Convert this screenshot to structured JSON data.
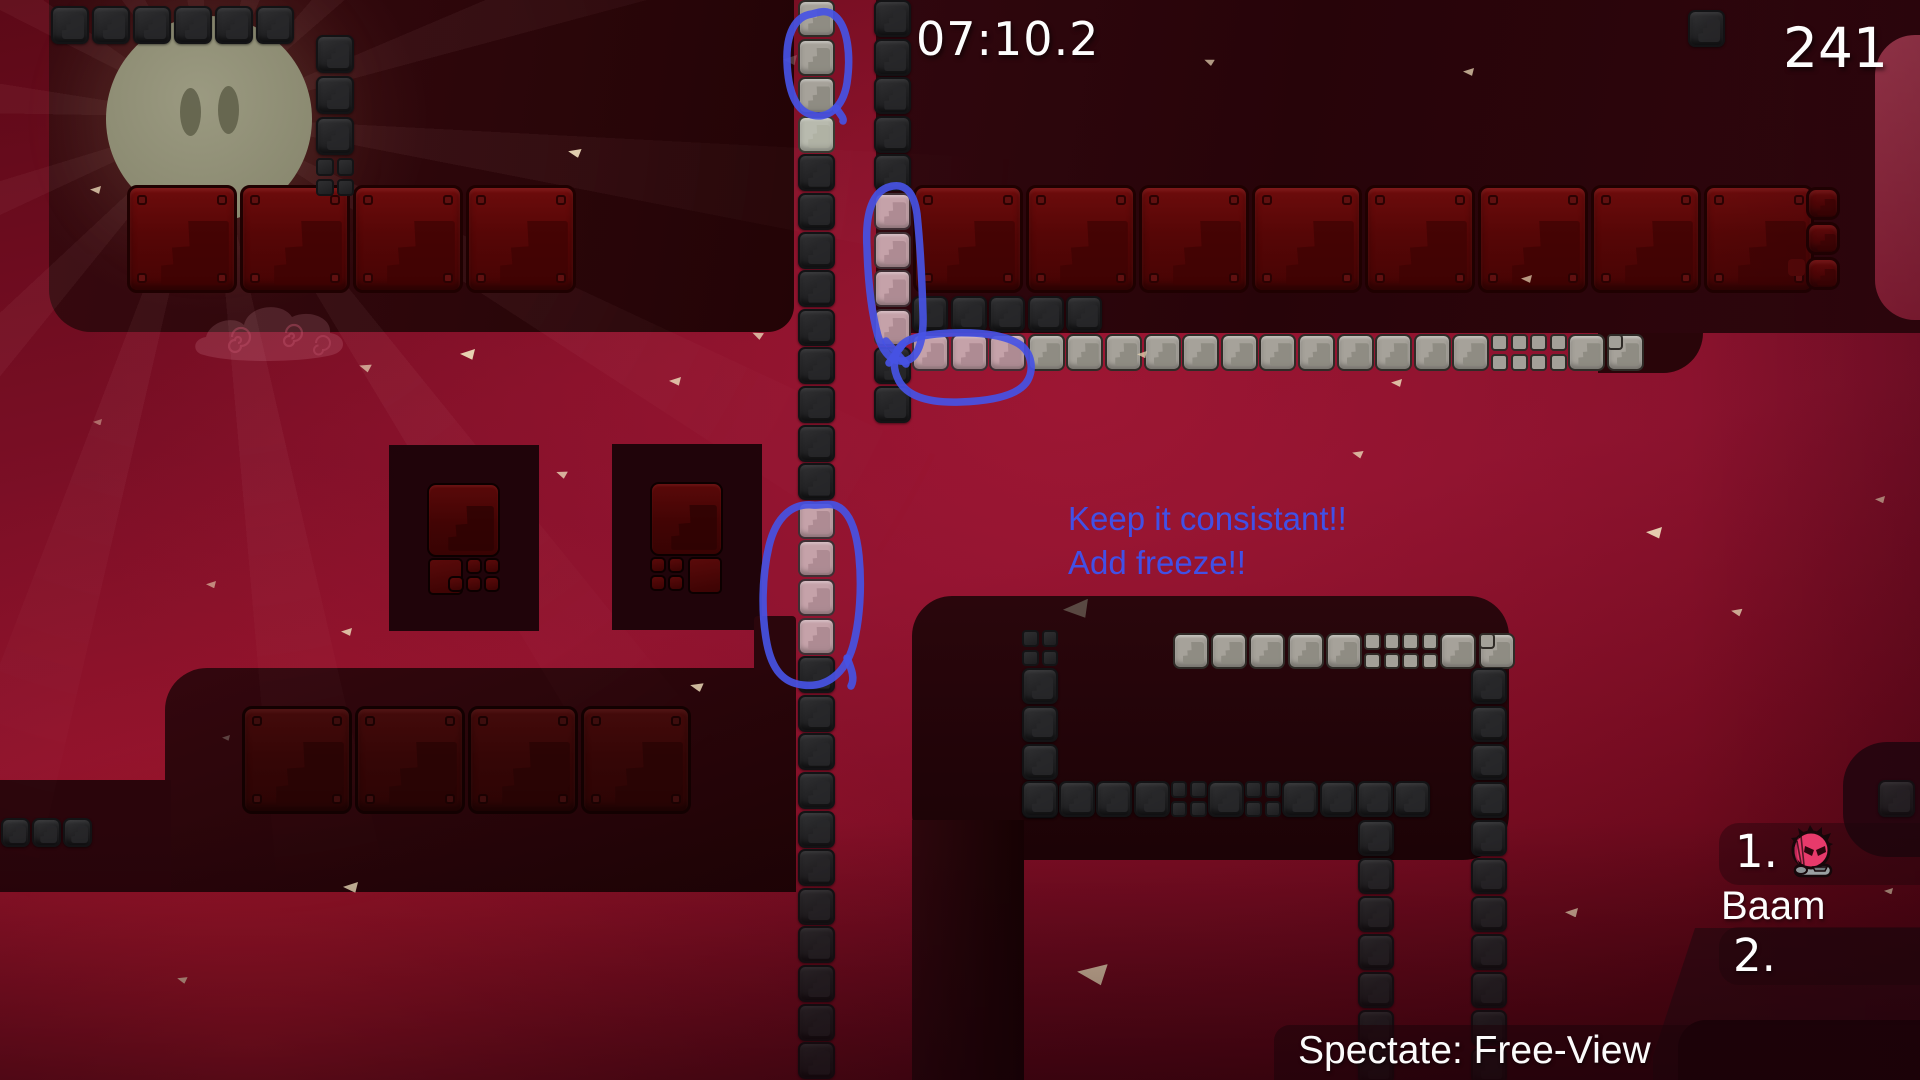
{
  "hud": {
    "timer": "07:10.2",
    "score": "241",
    "spectate_label": "Spectate: Free-View"
  },
  "leaderboard": {
    "entries": [
      {
        "rank": "1.",
        "name": "Baam",
        "icon": "pink-creature-icon"
      },
      {
        "rank": "2.",
        "name": ""
      }
    ]
  },
  "annotations": {
    "ink_color": "#4652e4",
    "text_color": "#4150e6",
    "notes": [
      "Keep it consistant!!",
      "Add freeze!!"
    ]
  },
  "palette": {
    "hud_text": "#fdfdfd",
    "brick_red": "#5c0808",
    "tile_dark": "#242426",
    "tile_light": "#a6a29a",
    "tile_pink": "#c5a2a9",
    "slab_dark": "#2a060c",
    "moon": "#93927b",
    "pillar_red": "#9e2e44"
  },
  "level": {
    "moon": {
      "eyes": 2
    },
    "slabs": [
      {
        "name": "slab-top-left",
        "x": 49,
        "y": 0,
        "w": 745,
        "h": 332,
        "r": "0 0 26px 42px",
        "bg": "radial-gradient(300px 280px at 170px 120px, rgba(190,120,95,.16), transparent 70%), linear-gradient(100deg,#37090f,#230406)"
      },
      {
        "name": "slab-top-right",
        "x": 876,
        "y": 0,
        "w": 1044,
        "h": 333,
        "r": "0",
        "bg": "linear-gradient(100deg,#30070e,#270409 40%,#2f060d)"
      },
      {
        "name": "slab-mid-left",
        "x": 165,
        "y": 668,
        "w": 631,
        "h": 224,
        "r": "42px 0 0 0",
        "bg": "linear-gradient(160deg,#33070e,#1e0305)"
      },
      {
        "name": "slab-mid-left-ext",
        "x": 0,
        "y": 780,
        "w": 171,
        "h": 112,
        "r": "0",
        "bg": "#2a050b"
      },
      {
        "name": "slab-bottom-mid",
        "x": 912,
        "y": 596,
        "w": 597,
        "h": 264,
        "r": "40px 40px 46px 46px",
        "bg": "linear-gradient(180deg,#2a060c,#1c0306)"
      },
      {
        "name": "slab-bottom-mid-arm",
        "x": 912,
        "y": 820,
        "w": 112,
        "h": 260,
        "r": "0",
        "bg": "linear-gradient(90deg,#2e070d,#160203)"
      },
      {
        "name": "slab-right-small",
        "x": 1843,
        "y": 742,
        "w": 77,
        "h": 115,
        "r": "44px 0 0 44px",
        "bg": "#2a0610"
      },
      {
        "name": "slab-bottom-right",
        "x": 1653,
        "y": 928,
        "w": 267,
        "h": 152,
        "r": "0",
        "bg": "#3a0913",
        "clip": "polygon(42px 0, 100% 0, 100% 100%, 0 100%, 0 128px)"
      },
      {
        "name": "slab-bottom-right-dark",
        "x": 1678,
        "y": 1020,
        "w": 242,
        "h": 60,
        "r": "28px 0 0 0",
        "bg": "#1f0308"
      },
      {
        "name": "pillar-right-red",
        "x": 1875,
        "y": 35,
        "w": 45,
        "h": 285,
        "r": "40px 0 0 40px",
        "bg": "linear-gradient(180deg,#a63c52,#8e2038)"
      }
    ],
    "strips": [
      {
        "name": "column-a",
        "x": 798,
        "y": 0,
        "dir": "v",
        "pitch": 38.6,
        "size": 37,
        "tone": "d",
        "tiles": "llledddddddddppppddddddddddd"
      },
      {
        "name": "column-b",
        "x": 874,
        "y": 0,
        "dir": "v",
        "pitch": 38.6,
        "size": 37,
        "tone": "d",
        "tiles": "dddddppppdd"
      },
      {
        "name": "top-left-row",
        "x": 51,
        "y": 6,
        "dir": "h",
        "pitch": 41,
        "size": 38,
        "tone": "d",
        "tiles": "dddddd"
      },
      {
        "name": "top-left-cluster",
        "x": 316,
        "y": 35,
        "dir": "v",
        "pitch": 41,
        "size": 38,
        "tone": "d",
        "tiles": "dddm"
      },
      {
        "name": "dark-row-top-right",
        "x": 912,
        "y": 296,
        "dir": "h",
        "pitch": 38.6,
        "size": 36,
        "tone": "d",
        "tiles": "ddddd"
      },
      {
        "name": "white-row-top-right",
        "x": 912,
        "y": 334,
        "dir": "h",
        "pitch": 38.6,
        "size": 37,
        "tone": "l",
        "tiles": "pppllllllllllllmmln"
      },
      {
        "name": "gray-row-bottom-mid",
        "x": 1173,
        "y": 633,
        "dir": "h",
        "pitch": 38.2,
        "size": 36,
        "tone": "l",
        "tiles": "lllllmmln"
      },
      {
        "name": "dark-col-bm-left",
        "x": 1022,
        "y": 630,
        "dir": "v",
        "pitch": 38,
        "size": 36,
        "tone": "d",
        "tiles": "mdddd"
      },
      {
        "name": "dark-row-bottom-mid",
        "x": 1022,
        "y": 781,
        "dir": "h",
        "pitch": 37.2,
        "size": 36,
        "tone": "d",
        "tiles": "ddddmdmdddd"
      },
      {
        "name": "dark-col-bm-right",
        "x": 1471,
        "y": 668,
        "dir": "v",
        "pitch": 38,
        "size": 36,
        "tone": "d",
        "tiles": "ddddddddddd"
      },
      {
        "name": "dark-col-bm-mid",
        "x": 1358,
        "y": 820,
        "dir": "v",
        "pitch": 38,
        "size": 36,
        "tone": "d",
        "tiles": "ddddddd"
      },
      {
        "name": "bottom-left-row",
        "x": 1,
        "y": 818,
        "dir": "h",
        "pitch": 31,
        "size": 29,
        "tone": "d",
        "tiles": "ddd"
      },
      {
        "name": "corner-tile-top-right",
        "x": 1688,
        "y": 10,
        "dir": "h",
        "pitch": 38,
        "size": 37,
        "tone": "d",
        "tiles": "d"
      },
      {
        "name": "tile-right-small-slab",
        "x": 1878,
        "y": 780,
        "dir": "h",
        "pitch": 38,
        "size": 37,
        "tone": "d",
        "tiles": "d"
      }
    ],
    "brickRows": [
      {
        "name": "bricks-top-left",
        "x": 127,
        "y": 185,
        "count": 4,
        "w": 110,
        "h": 108,
        "gap": 3,
        "dim": false,
        "vertical": false
      },
      {
        "name": "bricks-top-right",
        "x": 913,
        "y": 185,
        "count": 8,
        "w": 110,
        "h": 108,
        "gap": 3,
        "dim": false,
        "vertical": false
      },
      {
        "name": "bricks-mid-left",
        "x": 242,
        "y": 706,
        "count": 4,
        "w": 110,
        "h": 108,
        "gap": 3,
        "dim": true,
        "vertical": false
      },
      {
        "name": "bricks-small-stack",
        "x": 1806,
        "y": 187,
        "count": 3,
        "w": 34,
        "h": 33,
        "gap": 2,
        "dim": false,
        "vertical": true
      }
    ],
    "doors": [
      {
        "name": "door-structure-1",
        "x": 389,
        "y": 445,
        "variant": "left"
      },
      {
        "name": "door-structure-2",
        "x": 612,
        "y": 444,
        "variant": "right"
      }
    ],
    "extras": [
      {
        "name": "step-notch",
        "x": 754,
        "y": 616,
        "w": 42,
        "h": 54,
        "bg": "#2b060c",
        "r": "4px 4px 0 0"
      },
      {
        "name": "row-end-filler",
        "x": 1598,
        "y": 333,
        "w": 105,
        "h": 40,
        "bg": "#290509",
        "r": "0 0 44px 0"
      },
      {
        "name": "stack-mini-brick",
        "x": 1788,
        "y": 259,
        "w": 17,
        "h": 17,
        "bg": "#550808",
        "r": "4px"
      }
    ],
    "particles": [
      {
        "x": 90,
        "y": 186,
        "s": 11,
        "rot": 0,
        "o": 0.8
      },
      {
        "x": 568,
        "y": 148,
        "s": 13,
        "rot": 8,
        "o": 0.95
      },
      {
        "x": 669,
        "y": 377,
        "s": 12,
        "rot": 0,
        "o": 0.85
      },
      {
        "x": 359,
        "y": 363,
        "s": 12,
        "rot": 14,
        "o": 0.7
      },
      {
        "x": 460,
        "y": 349,
        "s": 15,
        "rot": 0,
        "o": 0.97
      },
      {
        "x": 752,
        "y": 331,
        "s": 11,
        "rot": 20,
        "o": 0.8
      },
      {
        "x": 206,
        "y": 581,
        "s": 10,
        "rot": 0,
        "o": 0.6
      },
      {
        "x": 690,
        "y": 682,
        "s": 13,
        "rot": 10,
        "o": 0.85
      },
      {
        "x": 343,
        "y": 882,
        "s": 15,
        "rot": 0,
        "o": 0.9
      },
      {
        "x": 177,
        "y": 976,
        "s": 10,
        "rot": 12,
        "o": 0.8
      },
      {
        "x": 222,
        "y": 735,
        "s": 8,
        "rot": 0,
        "o": 0.5,
        "c": "#8a7d76"
      },
      {
        "x": 341,
        "y": 628,
        "s": 11,
        "rot": 0,
        "o": 0.85
      },
      {
        "x": 556,
        "y": 470,
        "s": 11,
        "rot": 16,
        "o": 0.8
      },
      {
        "x": 1137,
        "y": 351,
        "s": 10,
        "rot": 0,
        "o": 0.75
      },
      {
        "x": 1391,
        "y": 379,
        "s": 11,
        "rot": 0,
        "o": 0.85
      },
      {
        "x": 1352,
        "y": 450,
        "s": 11,
        "rot": 10,
        "o": 0.8
      },
      {
        "x": 1521,
        "y": 275,
        "s": 11,
        "rot": 0,
        "o": 0.7
      },
      {
        "x": 1463,
        "y": 68,
        "s": 11,
        "rot": 0,
        "o": 0.75
      },
      {
        "x": 1204,
        "y": 58,
        "s": 10,
        "rot": 18,
        "o": 0.7
      },
      {
        "x": 1646,
        "y": 527,
        "s": 16,
        "rot": 0,
        "o": 0.95
      },
      {
        "x": 1731,
        "y": 608,
        "s": 11,
        "rot": 8,
        "o": 0.8
      },
      {
        "x": 1565,
        "y": 908,
        "s": 13,
        "rot": 0,
        "o": 0.8
      },
      {
        "x": 1077,
        "y": 963,
        "s": 30,
        "rot": 4,
        "o": 0.95
      },
      {
        "x": 1875,
        "y": 496,
        "s": 10,
        "rot": 0,
        "o": 0.7
      },
      {
        "x": 1884,
        "y": 888,
        "s": 9,
        "rot": 0,
        "o": 0.8
      },
      {
        "x": 1063,
        "y": 600,
        "s": 26,
        "rot": -6,
        "o": 0.9,
        "c": "#5e5048"
      },
      {
        "x": 93,
        "y": 419,
        "s": 9,
        "rot": 0,
        "o": 0.45
      },
      {
        "x": 783,
        "y": 55,
        "s": 14,
        "rot": 0,
        "o": 0.3,
        "c": "#b9b2ae"
      }
    ]
  }
}
